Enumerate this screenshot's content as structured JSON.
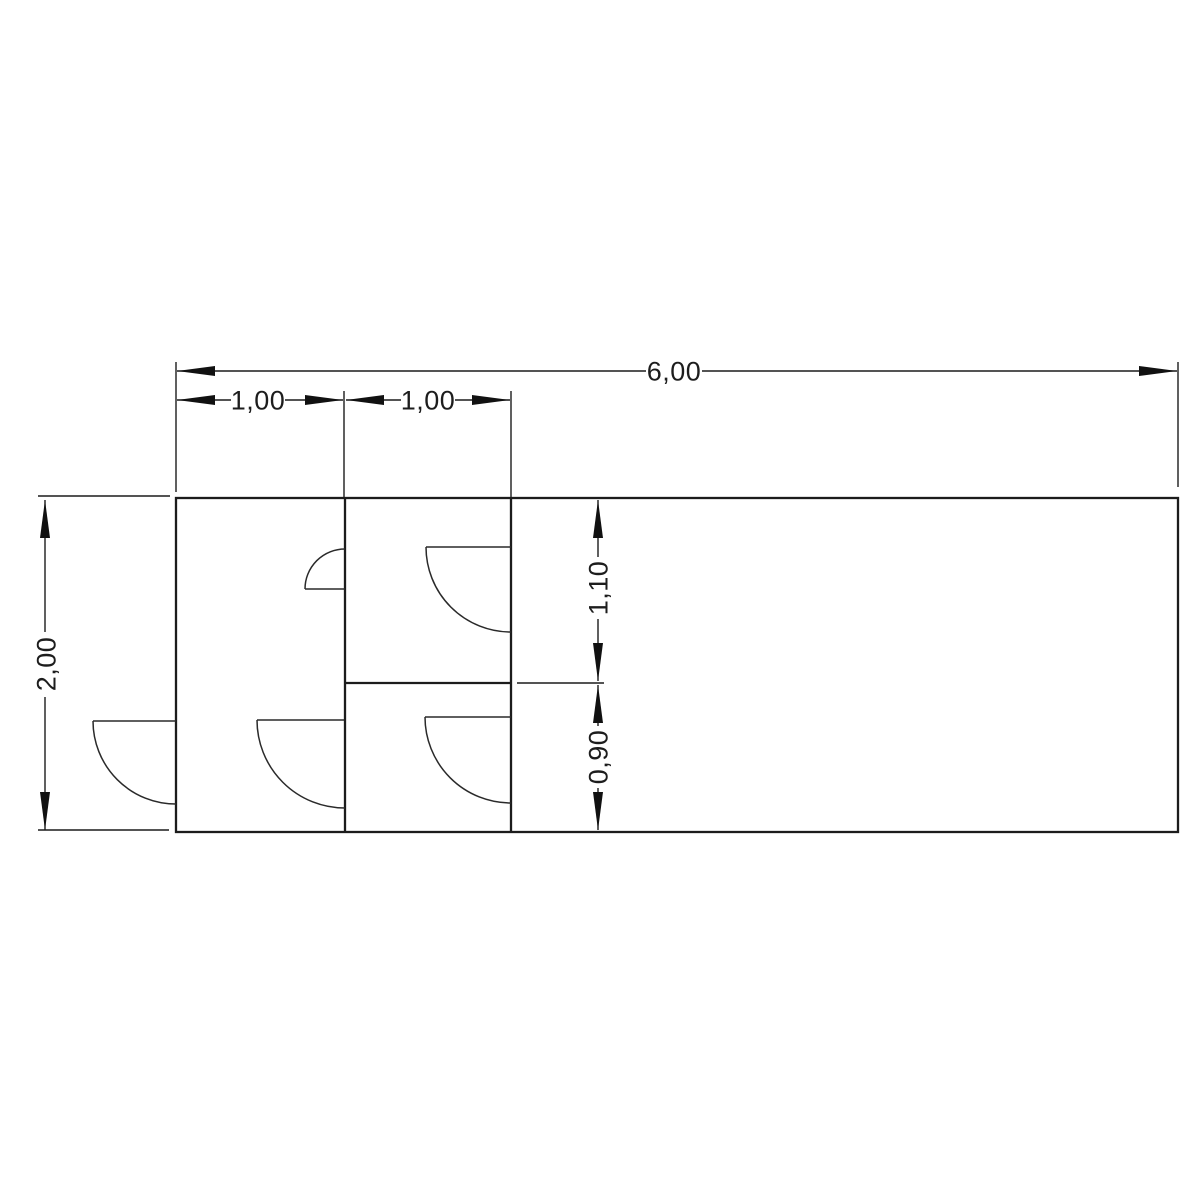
{
  "drawing": {
    "type": "floor-plan",
    "background": "#ffffff",
    "colors": {
      "line": "#1c1c1c",
      "thin_line": "#2a2a2a",
      "arrow": "#111111",
      "text": "#1d1d1d"
    },
    "dimensions": {
      "total_width": "6,00",
      "bay1_width": "1,00",
      "bay2_width": "1,00",
      "total_height": "2,00",
      "upper_room_depth": "1,10",
      "lower_room_depth": "0,90"
    }
  }
}
